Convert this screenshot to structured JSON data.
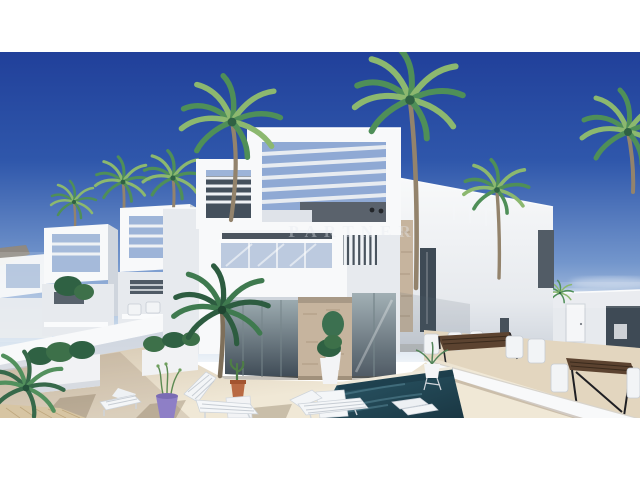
{
  "image": {
    "description": "3D architectural rendering of a development of modern white two-storey villas with rooftop pergolas, glass balconies, palm trees, a private plunge pool, outdoor wooden dining tables and white sun loungers on a beige terrace under a deep blue sky; white letterbox bands above and below the photo",
    "watermark": {
      "text": "PARTNER"
    },
    "objects": [
      "sky",
      "clouds",
      "distant-hill",
      "row-of-villas",
      "main-villa",
      "pergola-frame",
      "vertical-louvers",
      "glass-balcony",
      "stone-cladding",
      "right-villa",
      "perimeter-walls",
      "neighbor-terrace",
      "wooden-dining-tables",
      "white-chairs",
      "plunge-pool",
      "sun-loungers",
      "palm-trees",
      "planters",
      "purple-pot",
      "cactus-pot",
      "terrace-floor"
    ]
  },
  "palette": {
    "sky_top": "#21409a",
    "sky_mid": "#2f57ab",
    "sky_low": "#7396cc",
    "sky_horizon": "#c6d6e8",
    "sky_haze": "#eef3f8",
    "white_sunlit": "#f8f9fa",
    "white_face": "#e7eaee",
    "white_shade": "#cfd5dd",
    "white_shade2": "#b7bec9",
    "glass_dark": "#3e4a55",
    "glass_blue": "#bccadf",
    "glass_reflect": "#9cabb0",
    "stone": "#c6b49e",
    "stone_dark": "#9e8a72",
    "floor_sun": "#f0e8d6",
    "floor_warm": "#e3d6bf",
    "floor_shade": "#d5c7b1",
    "pool_deep": "#1a3743",
    "pool_mid": "#2c5a6a",
    "pool_light": "#5b8c9b",
    "palm_light": "#8cb86f",
    "palm_mid": "#4f8f58",
    "palm_dark": "#2f6143",
    "trunk": "#93836c",
    "wood": "#5c4330",
    "wood_dark": "#3a2a1c",
    "purple_pot": "#8e7fc6",
    "terracotta": "#b96a43",
    "hill": "#6a5a44",
    "watermark": "#e8ebf1"
  }
}
